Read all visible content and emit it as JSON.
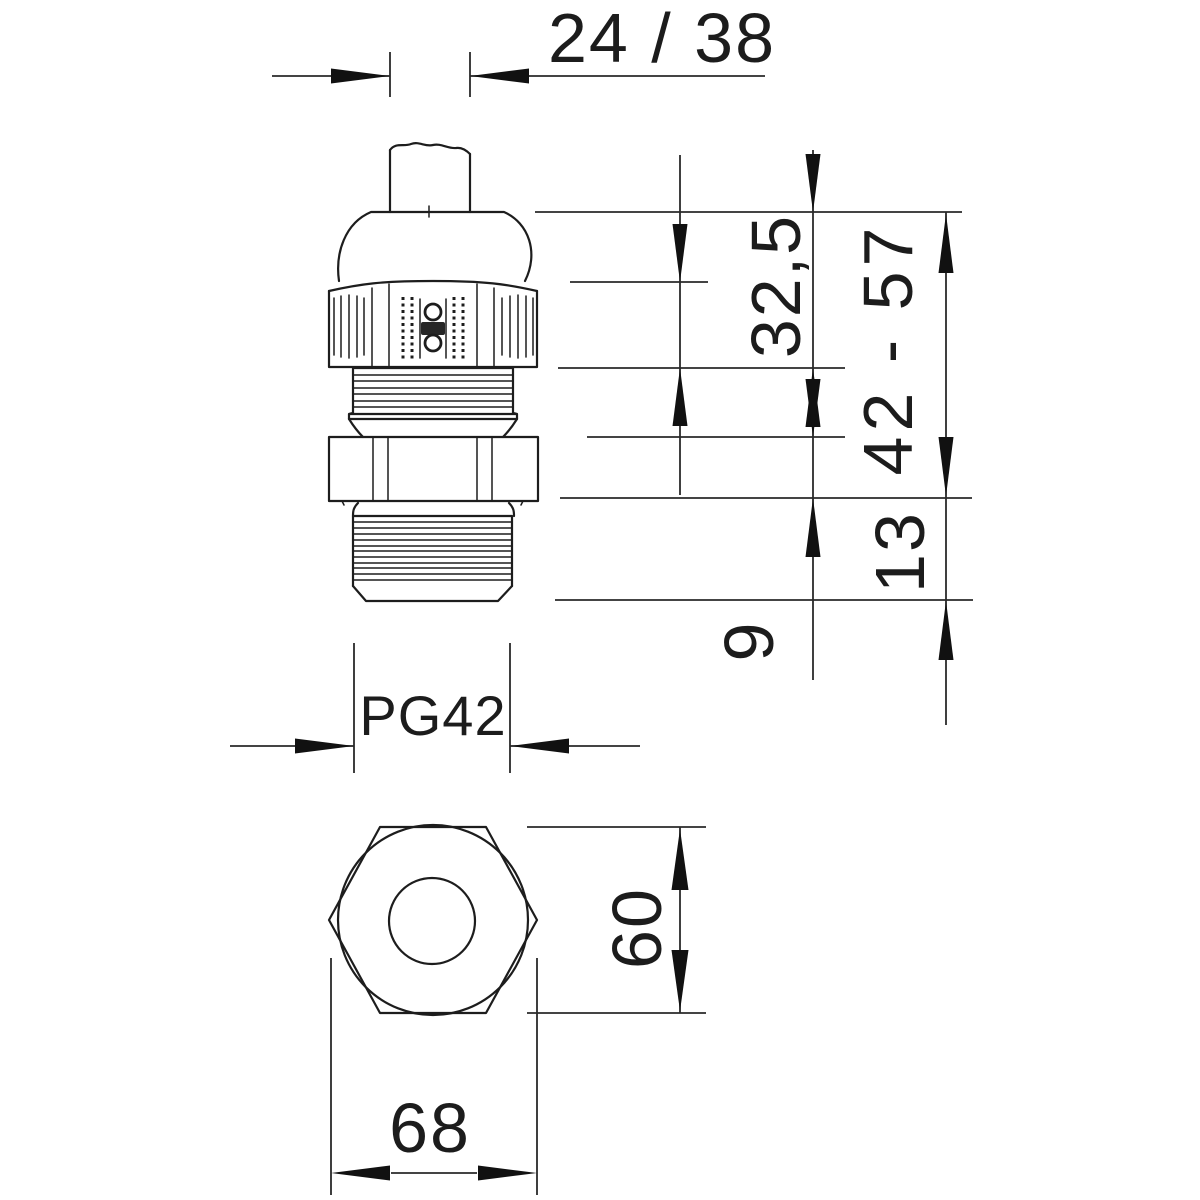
{
  "drawing": {
    "background": "#ffffff",
    "line_color": "#1d1d1d",
    "labels": {
      "top_width": "24 / 38",
      "cap_height": "32,5",
      "height_range": "42 - 57",
      "lock_nut_height": "13",
      "offset": "9",
      "thread": "PG42",
      "across_flats": "60",
      "across_corners": "68"
    }
  }
}
